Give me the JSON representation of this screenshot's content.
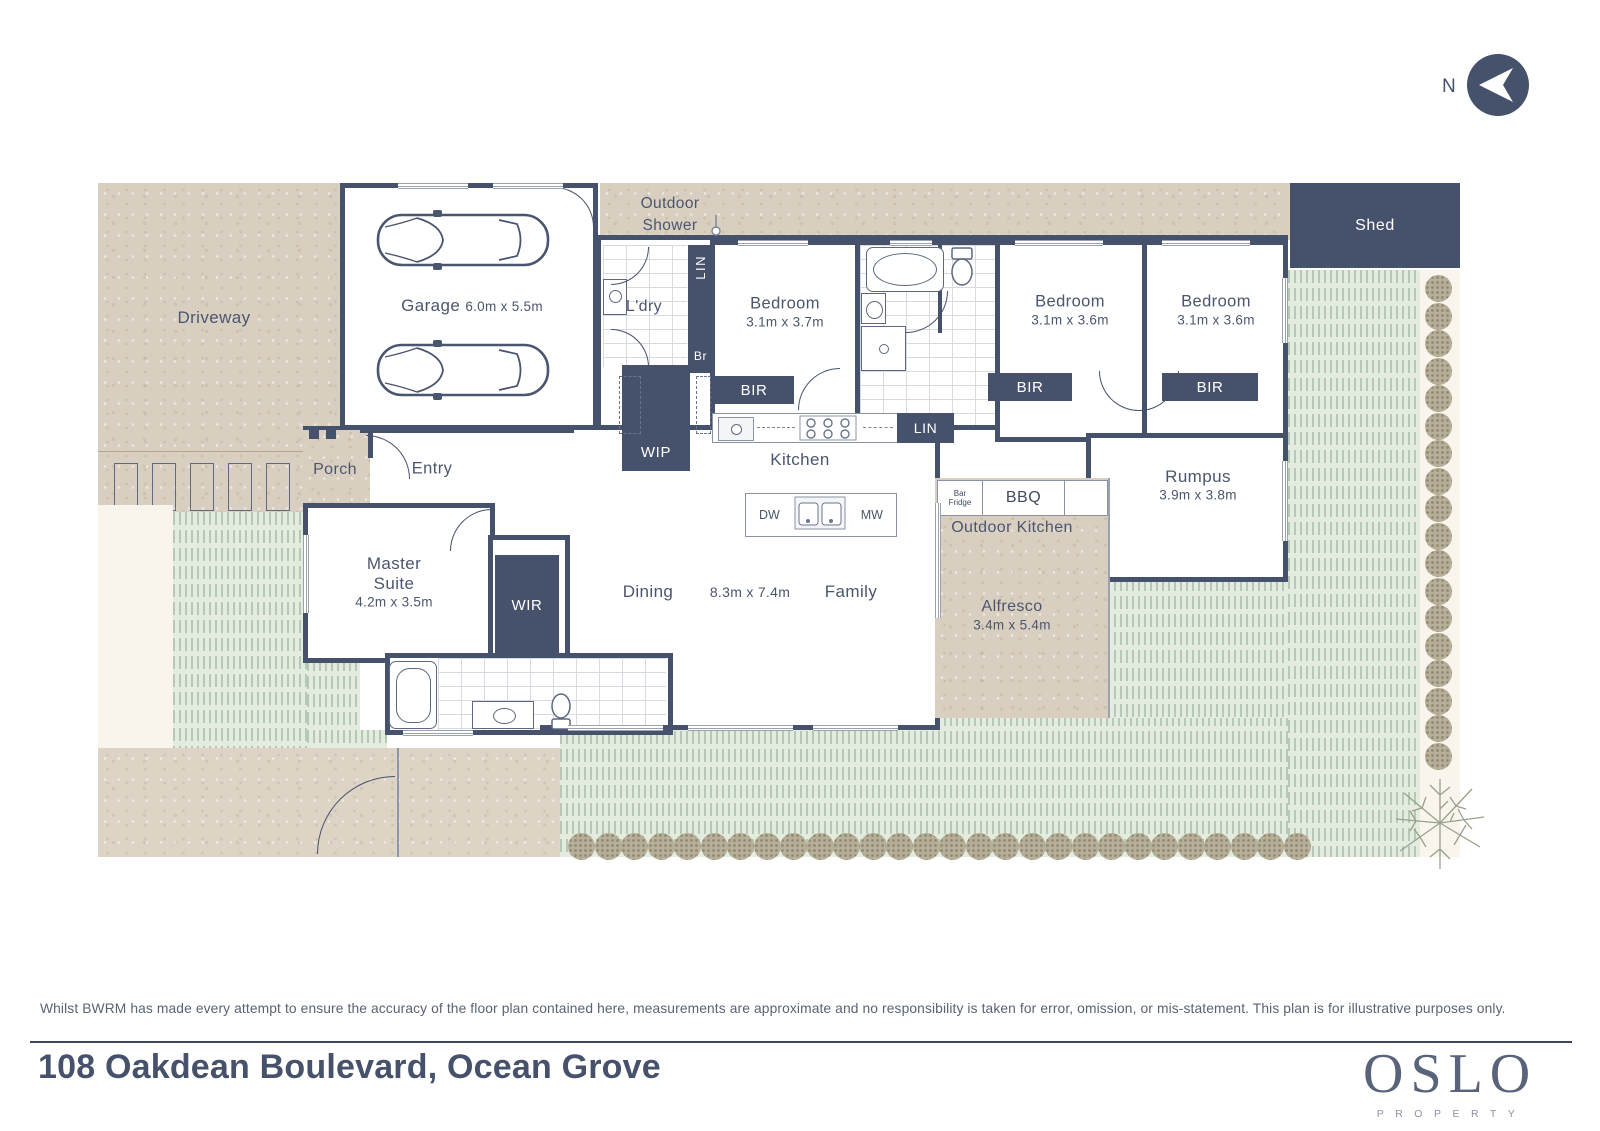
{
  "north": {
    "label": "N"
  },
  "plan": {
    "driveway": "Driveway",
    "porch": "Porch",
    "entry": "Entry",
    "outdoor_shower_1": "Outdoor",
    "outdoor_shower_2": "Shower",
    "garage": "Garage",
    "garage_dims": "6.0m x 5.5m",
    "ldry": "L'dry",
    "lin": "LIN",
    "br": "Br",
    "wip": "WIP",
    "bir": "BIR",
    "bedroom": "Bedroom",
    "bedroom1_dims": "3.1m x 3.7m",
    "bedroom2_dims": "3.1m x 3.6m",
    "bedroom3_dims": "3.1m x 3.6m",
    "shed": "Shed",
    "kitchen": "Kitchen",
    "lin2": "LIN",
    "dw": "DW",
    "mw": "MW",
    "dining": "Dining",
    "living_dims": "8.3m x 7.4m",
    "family": "Family",
    "master_1": "Master",
    "master_2": "Suite",
    "master_dims": "4.2m x 3.5m",
    "wir": "WIR",
    "rumpus": "Rumpus",
    "rumpus_dims": "3.9m x 3.8m",
    "bar_fridge_1": "Bar",
    "bar_fridge_2": "Fridge",
    "bbq": "BBQ",
    "outdoor_kitchen": "Outdoor Kitchen",
    "alfresco": "Alfresco",
    "alfresco_dims": "3.4m x 5.4m"
  },
  "footer": {
    "disclaimer": "Whilst BWRM has made every attempt to ensure the accuracy of the floor plan contained here, measurements are approximate and no responsibility is taken for error, omission, or mis-statement. This plan is for illustrative purposes only.",
    "address": "108 Oakdean Boulevard, Ocean Grove"
  },
  "logo": {
    "name": "OSLO",
    "tagline": "PROPERTY"
  },
  "colors": {
    "wall": "#46516b",
    "label": "#4b566e",
    "stone": "#d9cfc1",
    "stone_light": "#ded4c6",
    "grass": "#e4ecdf",
    "grass_dash": "#b6c9b5",
    "cream": "#faf5ec"
  }
}
